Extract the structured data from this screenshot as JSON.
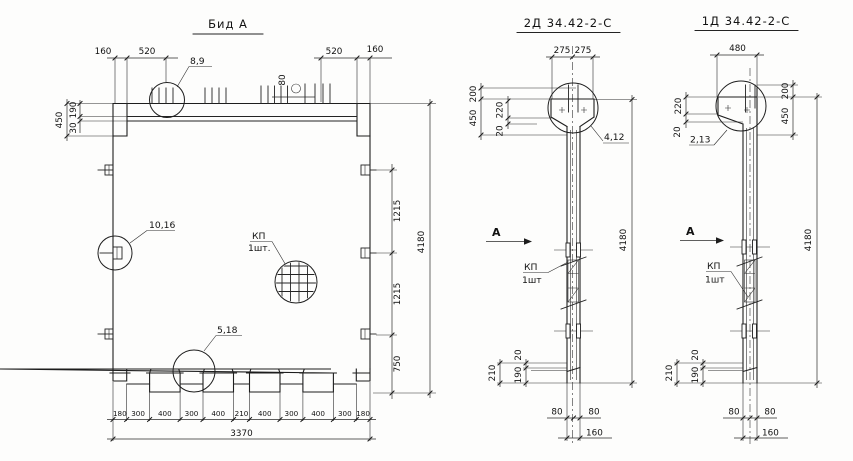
{
  "view_a": {
    "title": "Бид А",
    "dim_160_left": "160",
    "dim_520_left": "520",
    "dim_520_right": "520",
    "dim_160_right": "160",
    "dim_80_top": "80",
    "dim_450": "450",
    "dim_190": "190",
    "dim_30": "30",
    "dim_1215_a": "1215",
    "dim_1215_b": "1215",
    "dim_750": "750",
    "dim_4180": "4180",
    "dims_bottom": [
      "180",
      "300",
      "400",
      "300",
      "400",
      "210",
      "400",
      "300",
      "400",
      "300",
      "180"
    ],
    "dim_3370": "3370",
    "callout_top": "8,9",
    "callout_left": "10,16",
    "callout_bottom": "5,18",
    "kp_label": "КП",
    "kp_qty": "1шт."
  },
  "view_2d": {
    "title": "2Д 34.42-2-С",
    "dim_275_a": "275",
    "dim_275_b": "275",
    "dim_200": "200",
    "dim_450": "450",
    "dim_220": "220",
    "dim_20_top": "20",
    "callout": "4,12",
    "section_mark": "А",
    "kp_label": "КП",
    "kp_qty": "1шт",
    "dim_4180": "4180",
    "dim_210": "210",
    "dim_190": "190",
    "dim_20_bottom": "20",
    "dim_80_a": "80",
    "dim_80_b": "80",
    "dim_160": "160"
  },
  "view_1d": {
    "title": "1Д 34.42-2-С",
    "dim_480": "480",
    "dim_200": "200",
    "dim_450": "450",
    "dim_220": "220",
    "dim_20_top": "20",
    "callout": "2,13",
    "section_mark": "А",
    "kp_label": "КП",
    "kp_qty": "1шт",
    "dim_4180": "4180",
    "dim_210": "210",
    "dim_190": "190",
    "dim_20_bottom": "20",
    "dim_80_a": "80",
    "dim_80_b": "80",
    "dim_160": "160"
  }
}
